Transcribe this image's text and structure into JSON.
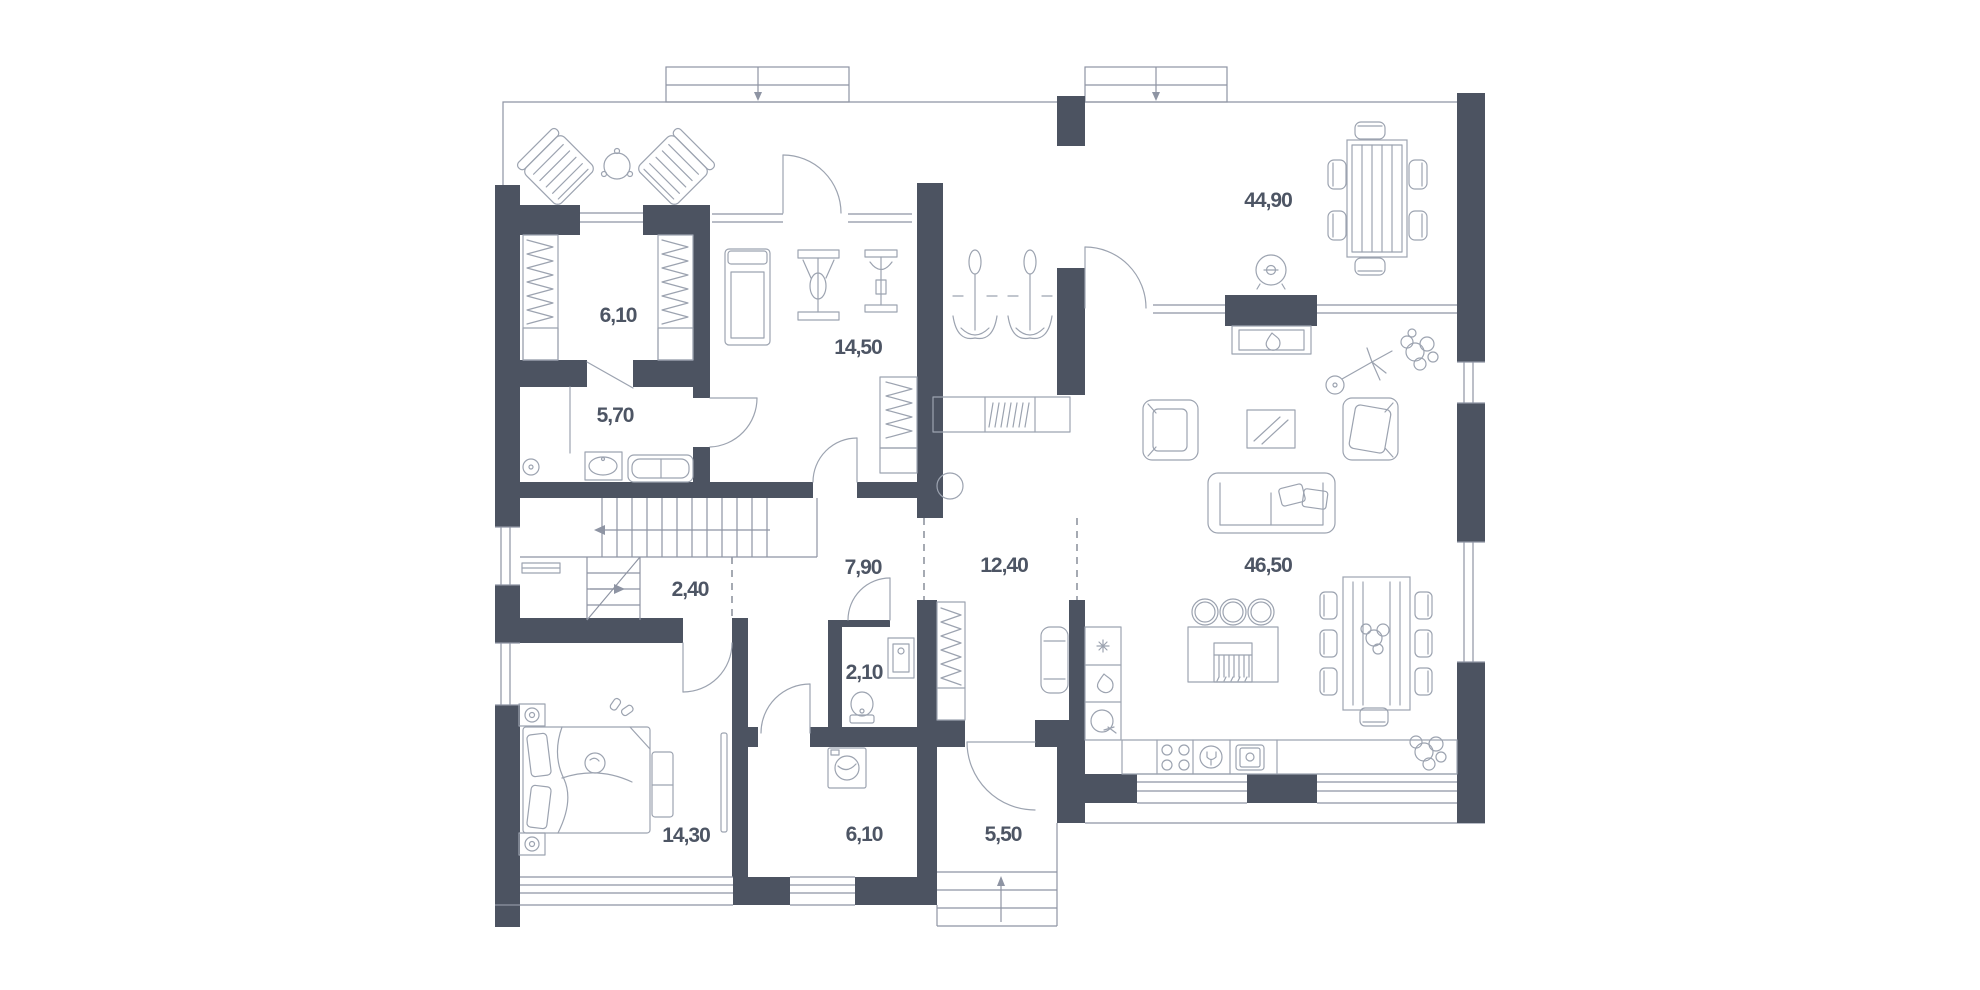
{
  "plan": {
    "name": "house-floor-plan",
    "colors": {
      "wall": "#4c5361",
      "furniture_line": "#9ca3b0",
      "structure_line": "#8e94a3",
      "label_text": "#4d5564",
      "background": "#ffffff"
    },
    "rooms": [
      {
        "id": "closet",
        "label": "6,10"
      },
      {
        "id": "bathroom",
        "label": "5,70"
      },
      {
        "id": "gym",
        "label": "14,50"
      },
      {
        "id": "terrace",
        "label": "44,90"
      },
      {
        "id": "stair-hall",
        "label": "2,40"
      },
      {
        "id": "hallway",
        "label": "7,90"
      },
      {
        "id": "corridor",
        "label": "12,40"
      },
      {
        "id": "living-kitchen",
        "label": "46,50"
      },
      {
        "id": "wc",
        "label": "2,10"
      },
      {
        "id": "laundry",
        "label": "6,10"
      },
      {
        "id": "entry",
        "label": "5,50"
      },
      {
        "id": "bedroom",
        "label": "14,30"
      }
    ]
  }
}
